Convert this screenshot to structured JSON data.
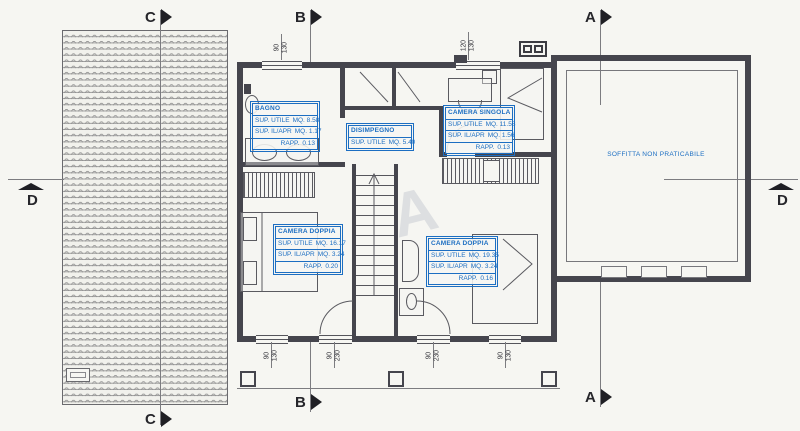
{
  "colors": {
    "annotation": "#1c6ec2",
    "ink": "#45454d"
  },
  "sections": {
    "a": "A",
    "b": "B",
    "c": "C",
    "d": "D"
  },
  "dimensions": {
    "top_window_left": {
      "w": "90",
      "h": "130"
    },
    "top_window_right": {
      "w": "120",
      "h": "130"
    },
    "bottom_1": {
      "w": "90",
      "h": "130"
    },
    "bottom_2": {
      "w": "90",
      "h": "230"
    },
    "bottom_3": {
      "w": "90",
      "h": "230"
    },
    "bottom_4": {
      "w": "90",
      "h": "130"
    }
  },
  "room_boxes": {
    "bagno": {
      "title": "BAGNO",
      "sup_utile_label": "SUP. UTILE",
      "sup_utile": "MQ. 8.58",
      "sup_ilapr_label": "SUP. IL/APR",
      "sup_ilapr": "MQ. 1.17",
      "rapp_label": "RAPP.",
      "rapp": "0.13"
    },
    "disimpegno": {
      "title": "DISIMPEGNO",
      "sup_utile_label": "SUP. UTILE",
      "sup_utile": "MQ. 5.40"
    },
    "camera_singola": {
      "title": "CAMERA SINGOLA",
      "sup_utile_label": "SUP. UTILE",
      "sup_utile": "MQ. 11.58",
      "sup_ilapr_label": "SUP. IL/APR",
      "sup_ilapr": "MQ. 1.56",
      "rapp_label": "RAPP.",
      "rapp": "0.13"
    },
    "camera_doppia_left": {
      "title": "CAMERA DOPPIA",
      "sup_utile_label": "SUP. UTILE",
      "sup_utile": "MQ. 16.17",
      "sup_ilapr_label": "SUP. IL/APR",
      "sup_ilapr": "MQ. 3.24",
      "rapp_label": "RAPP.",
      "rapp": "0.20"
    },
    "camera_doppia_right": {
      "title": "CAMERA DOPPIA",
      "sup_utile_label": "SUP. UTILE",
      "sup_utile": "MQ. 19.35",
      "sup_ilapr_label": "SUP. IL/APR",
      "sup_ilapr": "MQ. 3.24",
      "rapp_label": "RAPP.",
      "rapp": "0.16"
    }
  },
  "attic_label": "SOFFITTA NON PRATICABILE",
  "watermark": "A"
}
